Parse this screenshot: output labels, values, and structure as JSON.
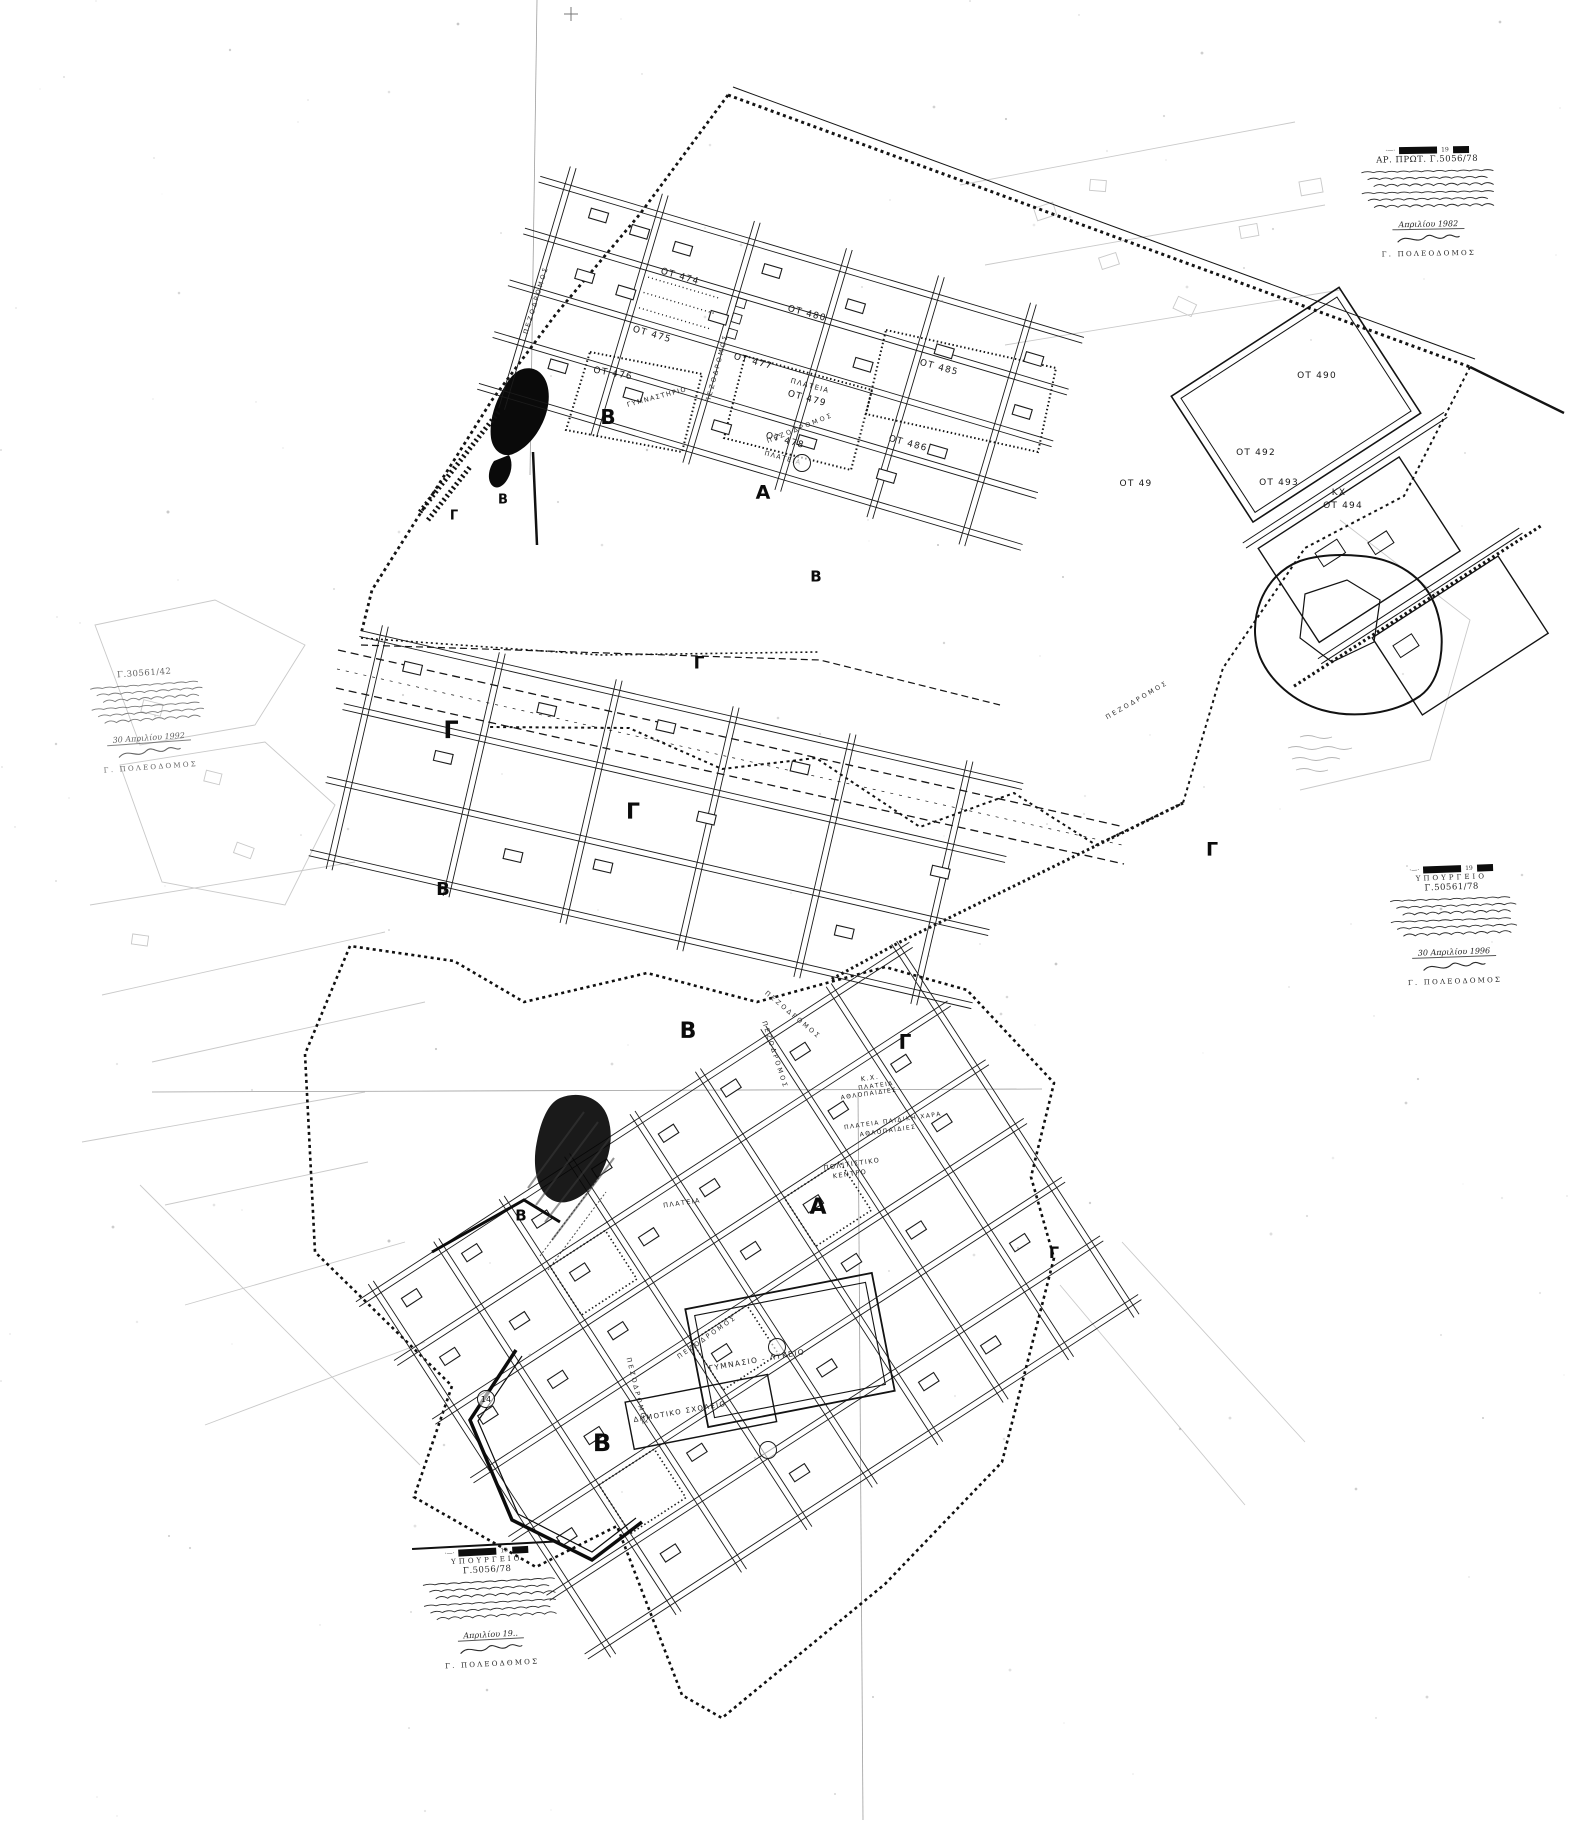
{
  "meta": {
    "document_kind": "Scanned town-plan sheet (photocopy)",
    "colors": {
      "paper": "#ffffff",
      "ink": "#141414",
      "faint_lines": "#c9c9c9"
    }
  },
  "labels": {
    "blocks": [
      {
        "text": "ΟΤ 474",
        "x": 680,
        "y": 277,
        "r": 16
      },
      {
        "text": "ΟΤ 475",
        "x": 652,
        "y": 335,
        "r": 16
      },
      {
        "text": "ΟΤ 476",
        "x": 613,
        "y": 374,
        "r": 10
      },
      {
        "text": "ΟΤ 477",
        "x": 753,
        "y": 362,
        "r": 15
      },
      {
        "text": "ΟΤ 478",
        "x": 785,
        "y": 441,
        "r": 15
      },
      {
        "text": "ΟΤ 479",
        "x": 807,
        "y": 399,
        "r": 15
      },
      {
        "text": "ΟΤ 480",
        "x": 807,
        "y": 314,
        "r": 15
      },
      {
        "text": "ΟΤ 485",
        "x": 939,
        "y": 368,
        "r": 15
      },
      {
        "text": "ΟΤ 486",
        "x": 908,
        "y": 444,
        "r": 15
      },
      {
        "text": "ΟΤ 490",
        "x": 1317,
        "y": 376,
        "r": 0
      },
      {
        "text": "ΟΤ 49",
        "x": 1136,
        "y": 484,
        "r": 0
      },
      {
        "text": "ΟΤ 492",
        "x": 1256,
        "y": 453,
        "r": 0
      },
      {
        "text": "ΟΤ 493",
        "x": 1279,
        "y": 483,
        "r": 0
      },
      {
        "text": "ΚΧ",
        "x": 1339,
        "y": 493,
        "r": 0
      },
      {
        "text": "ΟΤ 494",
        "x": 1343,
        "y": 506,
        "r": 0
      }
    ],
    "zones": [
      {
        "text": "Β",
        "x": 503,
        "y": 500,
        "s": 13
      },
      {
        "text": "Γ",
        "x": 454,
        "y": 516,
        "s": 13
      },
      {
        "text": "Β",
        "x": 608,
        "y": 417,
        "s": 20
      },
      {
        "text": "Α",
        "x": 763,
        "y": 493,
        "s": 19
      },
      {
        "text": "Β",
        "x": 816,
        "y": 577,
        "s": 15
      },
      {
        "text": "Γ",
        "x": 699,
        "y": 664,
        "s": 17
      },
      {
        "text": "Γ",
        "x": 451,
        "y": 730,
        "s": 24
      },
      {
        "text": "Γ",
        "x": 633,
        "y": 813,
        "s": 22
      },
      {
        "text": "Γ",
        "x": 1212,
        "y": 850,
        "s": 19
      },
      {
        "text": "Β",
        "x": 443,
        "y": 890,
        "s": 18
      },
      {
        "text": "Β",
        "x": 688,
        "y": 1032,
        "s": 22
      },
      {
        "text": "Γ",
        "x": 905,
        "y": 1042,
        "s": 20
      },
      {
        "text": "Β",
        "x": 521,
        "y": 1216,
        "s": 15
      },
      {
        "text": "Α",
        "x": 818,
        "y": 1208,
        "s": 22
      },
      {
        "text": "Γ",
        "x": 1054,
        "y": 1253,
        "s": 16
      },
      {
        "text": "Β",
        "x": 602,
        "y": 1443,
        "s": 24
      }
    ],
    "streets": [
      {
        "text": "ΠΕΖΟΔΡΟΜΟΣ",
        "x": 536,
        "y": 300,
        "r": -73
      },
      {
        "text": "ΠΕΖΟΔΡΟΜΟΣ",
        "x": 717,
        "y": 368,
        "r": -75
      },
      {
        "text": "ΠΕΖΟΔΡΟΜΟΣ",
        "x": 800,
        "y": 428,
        "r": -22
      },
      {
        "text": "ΠΕΖΟΔΡΟΜΟΣ",
        "x": 1137,
        "y": 700,
        "r": -30
      },
      {
        "text": "ΠΕΖΟΔΡΟΜΟΣ",
        "x": 793,
        "y": 1015,
        "r": 40
      },
      {
        "text": "ΠΕΖΟΔΡΟΜΟΣ",
        "x": 775,
        "y": 1055,
        "r": 72
      },
      {
        "text": "ΠΕΖΟΔΡΟΜΟΣ",
        "x": 707,
        "y": 1337,
        "r": -35
      },
      {
        "text": "ΠΕΖΟΔΡΟΜΟΣ",
        "x": 637,
        "y": 1392,
        "r": 76
      }
    ],
    "features": [
      {
        "text": "ΠΛΑΤΕΙΑ",
        "x": 810,
        "y": 386,
        "r": 15,
        "s": 7
      },
      {
        "text": "ΠΛΑΤΕΙΑ",
        "x": 783,
        "y": 458,
        "r": 15,
        "s": 6.5
      },
      {
        "text": "ΓΥΜΝΑΣΤΗΡΙΟ",
        "x": 657,
        "y": 397,
        "r": -15,
        "s": 6.5
      },
      {
        "text": "Κ.Χ.",
        "x": 870,
        "y": 1078,
        "r": -8,
        "s": 6.5
      },
      {
        "text": "ΠΛΑΤΕΙΑ",
        "x": 876,
        "y": 1086,
        "r": -8,
        "s": 6
      },
      {
        "text": "ΑΘΛΟΠΑΙΔΙΕΣ",
        "x": 869,
        "y": 1094,
        "r": -8,
        "s": 6
      },
      {
        "text": "ΠΛΑΤΕΙΑ ΠΑΙΔΙΚΗ ΧΑΡΑ",
        "x": 893,
        "y": 1121,
        "r": -8,
        "s": 6
      },
      {
        "text": "ΑΘΛΟΠΑΙΔΙΕΣ",
        "x": 888,
        "y": 1131,
        "r": -8,
        "s": 6
      },
      {
        "text": "ΠΟΛΙΤΙΣΤΙΚΟ",
        "x": 852,
        "y": 1164,
        "r": -8,
        "s": 6.5
      },
      {
        "text": "ΚΕΝΤΡΟ",
        "x": 850,
        "y": 1174,
        "r": -8,
        "s": 6.5
      },
      {
        "text": "ΠΛΑΤΕΙΑ",
        "x": 682,
        "y": 1203,
        "r": -8,
        "s": 6.5
      },
      {
        "text": "ΓΥΜΝΑΣΙΟ - ΛΥΚΕΙΟ",
        "x": 757,
        "y": 1360,
        "r": -10,
        "s": 7.5
      },
      {
        "text": "ΔΗΜΟΤΙΚΟ ΣΧΟΛΕΙΟ",
        "x": 680,
        "y": 1412,
        "r": -10,
        "s": 7
      }
    ],
    "markers": [
      {
        "text": "14",
        "x": 486,
        "y": 1399
      },
      {
        "text": "",
        "x": 802,
        "y": 463
      },
      {
        "text": "",
        "x": 777,
        "y": 1347
      },
      {
        "text": "",
        "x": 768,
        "y": 1450
      }
    ]
  },
  "stamps": [
    {
      "id": "stamp-top-right",
      "x": 1352,
      "y": 148,
      "w": 150,
      "r": -1,
      "rule": false,
      "bar": true,
      "header": "",
      "reg": "ΑΡ. ΠΡΩΤ.  Γ.5056/78",
      "date": "Απριλίου 1982",
      "signer": "Γ. ΠΟΛΕΟΔΟΜΟΣ",
      "faint": false
    },
    {
      "id": "stamp-left",
      "x": 80,
      "y": 672,
      "w": 128,
      "r": -4,
      "rule": false,
      "bar": false,
      "header": "",
      "reg": "Γ.30561/42",
      "date": "30 Απριλίου 1992",
      "signer": "Γ. ΠΟΛΕΟΔΟΜΟΣ",
      "faint": true
    },
    {
      "id": "stamp-right",
      "x": 1380,
      "y": 868,
      "w": 142,
      "r": -2,
      "rule": false,
      "bar": true,
      "header": "ΥΠΟΥΡΓΕΙΟ",
      "reg": "Γ.50561/78",
      "date": "30 Απριλίου 1996",
      "signer": "Γ. ΠΟΛΕΟΔΟΜΟΣ",
      "faint": false
    },
    {
      "id": "stamp-bottom",
      "x": 412,
      "y": 1548,
      "w": 148,
      "r": -3,
      "rule": true,
      "bar": true,
      "header": "ΥΠΟΥΡΓΕΙΟ",
      "reg": "Γ.5056/78",
      "date": "Απριλίου 19..",
      "signer": "Γ. ΠΟΛΕΟΔΟΜΟΣ",
      "faint": false
    }
  ]
}
